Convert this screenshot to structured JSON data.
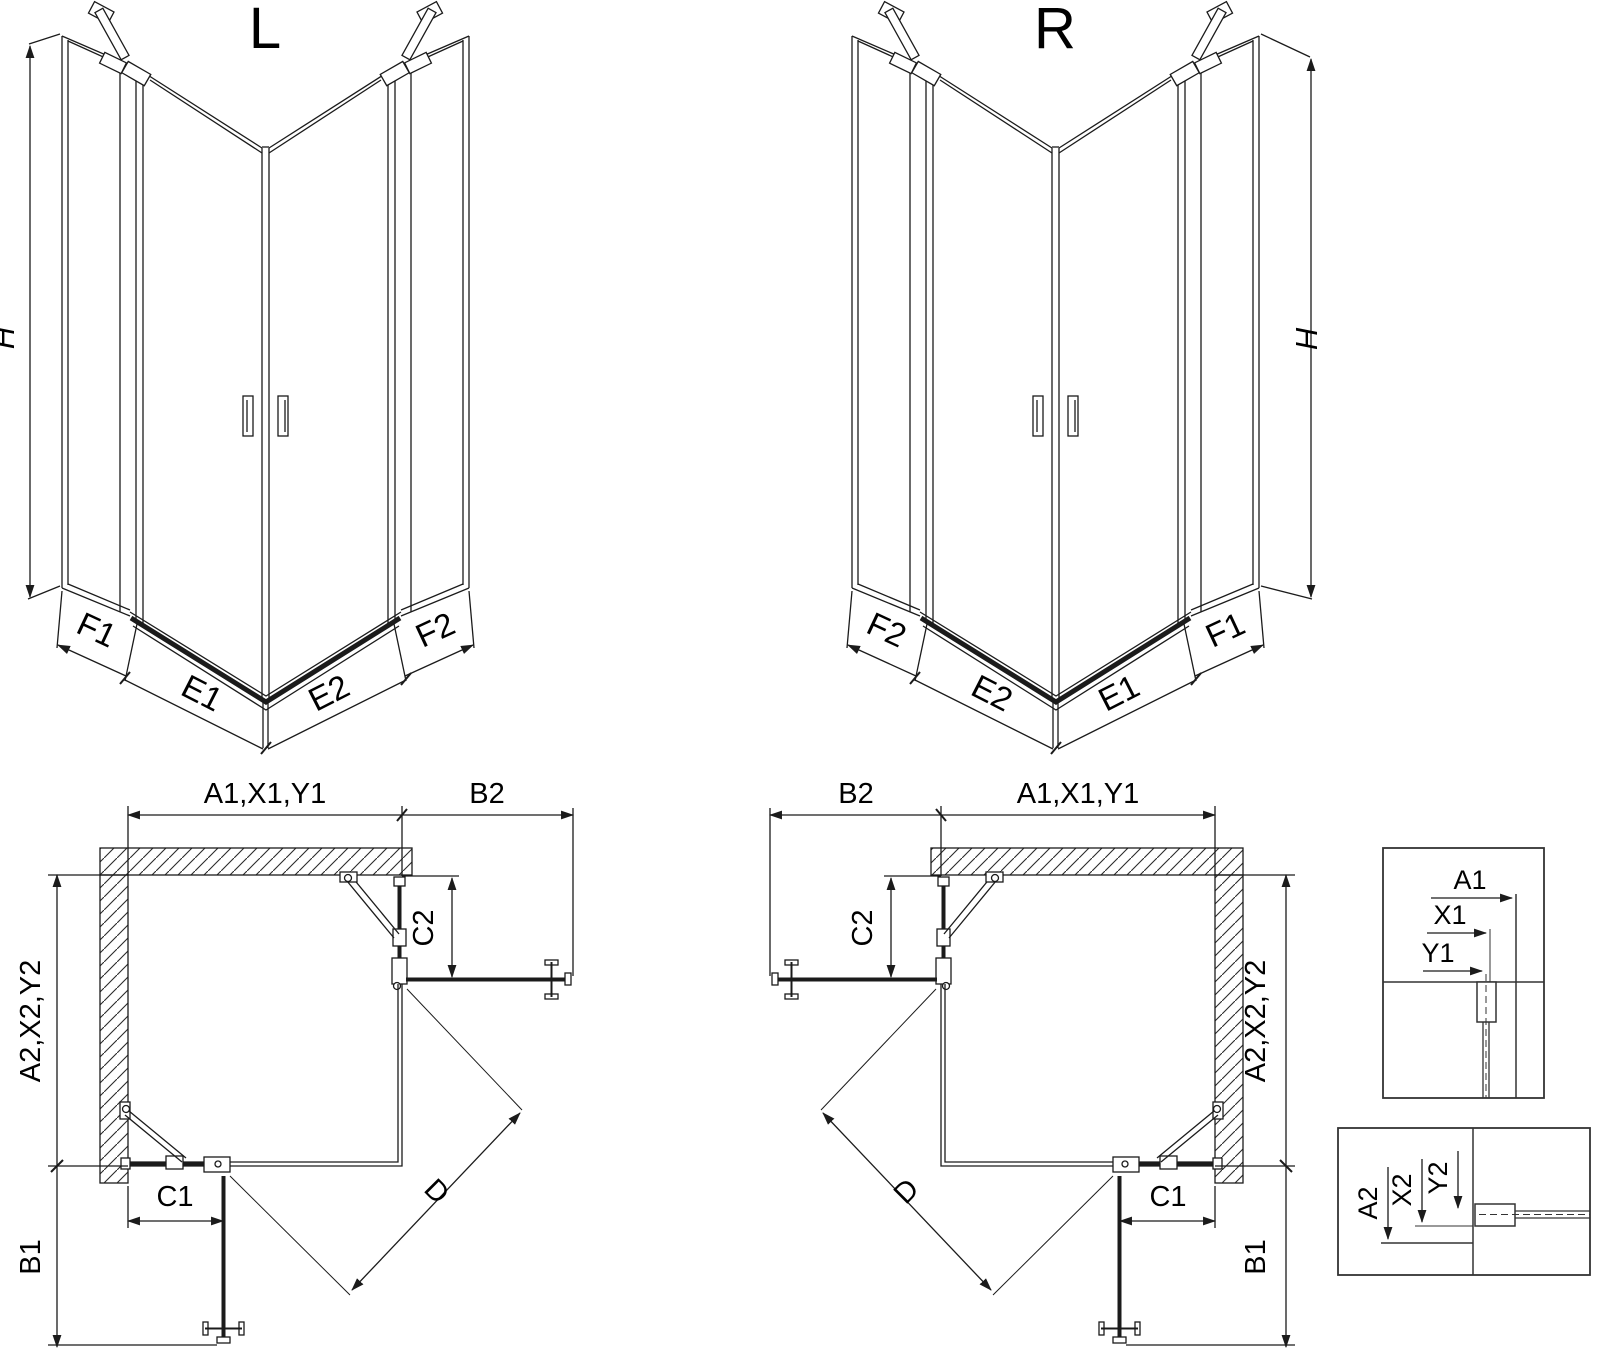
{
  "title_left": "L",
  "title_right": "R",
  "colors": {
    "line": "#1b1b1b",
    "text": "#000000",
    "background": "#ffffff"
  },
  "iso_left": {
    "height_label": "H",
    "bottom_labels": {
      "outer_left": "F1",
      "door_left": "E1",
      "door_right": "E2",
      "outer_right": "F2"
    }
  },
  "iso_right": {
    "height_label": "H",
    "bottom_labels": {
      "outer_left": "F2",
      "door_left": "E2",
      "door_right": "E1",
      "outer_right": "F1"
    }
  },
  "plan_left": {
    "width_main": "A1,X1,Y1",
    "width_door": "B2",
    "fixed_top": "C2",
    "depth_main": "A2,X2,Y2",
    "fixed_bottom": "C1",
    "door_side": "B1",
    "entry_diagonal": "D"
  },
  "plan_right": {
    "width_main": "A1,X1,Y1",
    "width_door": "B2",
    "fixed_top": "C2",
    "depth_main": "A2,X2,Y2",
    "fixed_bottom": "C1",
    "door_side": "B1",
    "entry_diagonal": "D"
  },
  "detail_width": {
    "a": "A1",
    "x": "X1",
    "y": "Y1"
  },
  "detail_depth": {
    "a": "A2",
    "x": "X2",
    "y": "Y2"
  }
}
